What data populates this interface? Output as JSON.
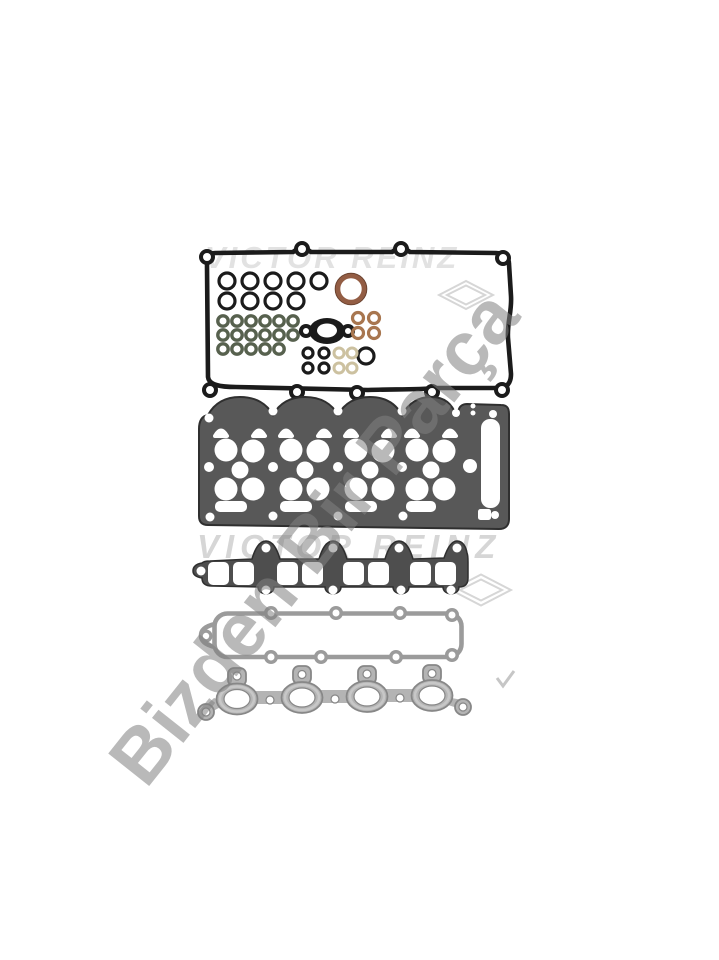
{
  "watermarks": {
    "brand_top": "VICTOR REINZ",
    "brand_middle": "VICTOR REINZ",
    "diagonal": "Bizden Bir Parça"
  },
  "colors": {
    "background": "#ffffff",
    "rubber_black": "#1b1b1b",
    "outline_dark": "#2f2f2f",
    "seal_brown": "#935d44",
    "seal_brown_dark": "#6a422f",
    "seal_green": "#57614e",
    "seal_tan": "#a8764f",
    "seal_cream": "#ccc1a0",
    "head_metal": "#585858",
    "intake_metal": "#4e4e4e",
    "frame_metal": "#9b9b9b",
    "exhaust_metal": "#b4b4b4",
    "exhaust_edge": "#878787",
    "watermark_light": "#e2e2e2",
    "watermark_mid": "#d6d6d6",
    "watermark_gray": "#818181",
    "watermark_logo": "#d6d6d6"
  },
  "parts": [
    {
      "id": "valve-cover-gasket",
      "kind": "black rubber perimeter gasket"
    },
    {
      "id": "o-ring-assortment",
      "black_large": 9,
      "green_small": 17,
      "tan_small": 4,
      "black_small": 4,
      "cream_small": 4,
      "copper_crank_seal": 1,
      "egr-plate": 1
    },
    {
      "id": "cylinder-head-gasket",
      "kind": "dark steel multi-hole gasket"
    },
    {
      "id": "intake-manifold-gasket",
      "kind": "dark steel 8-port gasket"
    },
    {
      "id": "plenum-frame-gasket",
      "kind": "light steel frame gasket"
    },
    {
      "id": "exhaust-manifold-gasket",
      "kind": "metallic 4-oval-port gasket"
    }
  ]
}
